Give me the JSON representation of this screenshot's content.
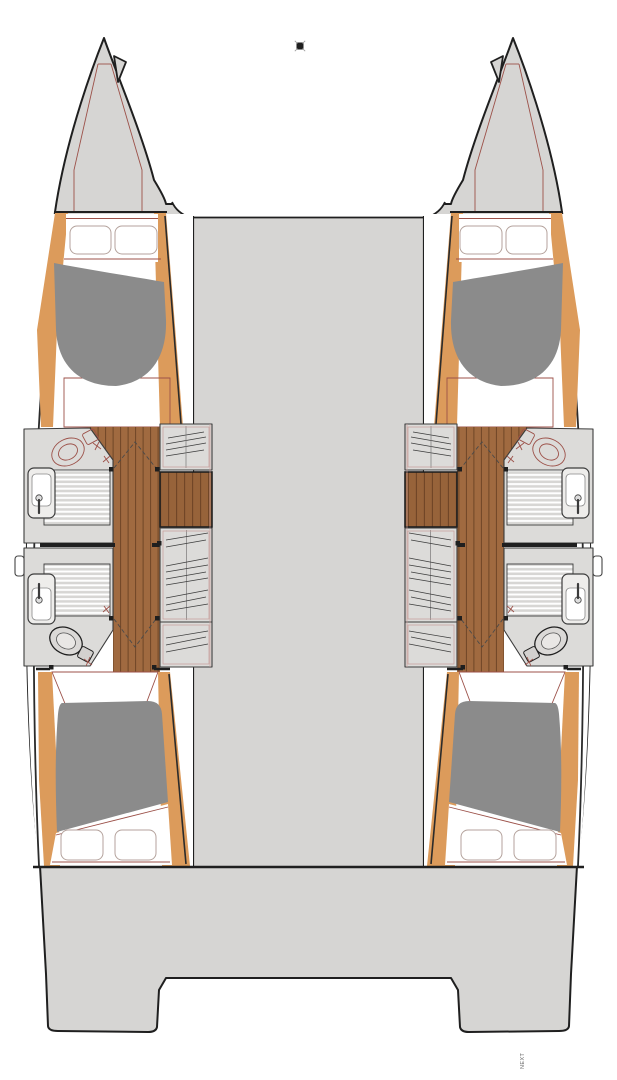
{
  "footer": {
    "note": "NEXT"
  },
  "marker": {
    "name": "registration-mark"
  },
  "colors": {
    "page_bg": "#ffffff",
    "hull_fill": "#d6d5d3",
    "outline": "#1f1f1f",
    "inner_line": "#2b2b2b",
    "wood_light": "#dc9b5b",
    "wood_floor": "#a06a40",
    "plank_line": "#6f4526",
    "step_wood": "#97633a",
    "bed_fill": "#8b8b8b",
    "pillow_stroke": "#b4a29c",
    "fixture_fill": "#eeedeb",
    "fixture_stroke": "#3c3c3c",
    "platform_fill": "#dcdbd9",
    "slat_bg": "#d7d6d4",
    "slat_line": "#ffffff",
    "thin_red": "#9c5149",
    "pink_line": "#c79c97",
    "dash_color": "#4a4a4a",
    "text_color": "#666666"
  }
}
